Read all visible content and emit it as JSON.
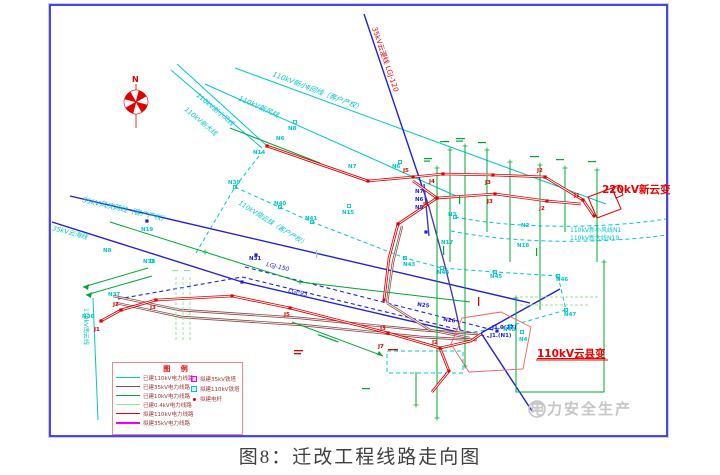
{
  "figure": {
    "caption": "图8：迁改工程线路走向图"
  },
  "watermark": {
    "text": "电力安全生产"
  },
  "legend": {
    "title": "图 例",
    "lines": [
      {
        "label": "已建110kV电力线路",
        "color": "#00c8c8",
        "weight": 1
      },
      {
        "label": "已建35kV电力线路",
        "color": "#8a4a4a",
        "weight": 1
      },
      {
        "label": "已建10kV电力线路",
        "color": "#00a832",
        "weight": 1
      },
      {
        "label": "已建0.4kV电力线路",
        "color": "#90e890",
        "weight": 1
      },
      {
        "label": "拟建110kV电力线路",
        "color": "#e80000",
        "weight": 1
      },
      {
        "label": "拟建35kV电力线路",
        "color": "#f000f0",
        "weight": 2
      }
    ],
    "symbols": [
      {
        "label": "拟建35kV铁塔",
        "type": "square",
        "color": "#f000f0"
      },
      {
        "label": "拟建110kV铁塔",
        "type": "square",
        "color": "#00c8c8"
      },
      {
        "label": "拟建电杆",
        "type": "dot",
        "color": "#e80000"
      }
    ]
  },
  "labels": [
    {
      "text": "N",
      "x": 132,
      "y": 82,
      "color": "#e00000",
      "size": 8,
      "bold": 1
    },
    {
      "text": "35kV云漫线  LGJ-120",
      "x": 372,
      "y": 28,
      "color": "#e80000",
      "size": 7,
      "rotate": 71
    },
    {
      "text": "110kV新小Ⅱ回线（客户产权）",
      "x": 272,
      "y": 76,
      "color": "#00c8c8",
      "size": 7,
      "rotate": 21,
      "italic": 1
    },
    {
      "text": "110kV新风线",
      "x": 238,
      "y": 100,
      "color": "#00c8c8",
      "size": 7,
      "rotate": 24,
      "italic": 1
    },
    {
      "text": "110kV新小风线",
      "x": 196,
      "y": 96,
      "color": "#00c8c8",
      "size": 6.5,
      "rotate": 40,
      "italic": 1
    },
    {
      "text": "110kV新大线",
      "x": 184,
      "y": 110,
      "color": "#00c8c8",
      "size": 6.5,
      "rotate": 40,
      "italic": 1
    },
    {
      "text": "35kV风庆网线（客户产权）",
      "x": 82,
      "y": 202,
      "color": "#00c8c8",
      "size": 7,
      "rotate": 13,
      "italic": 1
    },
    {
      "text": "35kV云海线",
      "x": 52,
      "y": 230,
      "color": "#00c8c8",
      "size": 6.5,
      "rotate": 15,
      "italic": 1
    },
    {
      "text": "110kV南云线（客户产权）",
      "x": 238,
      "y": 204,
      "color": "#00c8c8",
      "size": 6.5,
      "rotate": 32,
      "italic": 1
    },
    {
      "text": "110kV南云线",
      "x": 84,
      "y": 308,
      "color": "#00c8c8",
      "size": 6,
      "rotate": 90
    },
    {
      "text": "LGJ-150",
      "x": 266,
      "y": 266,
      "color": "#2020dd",
      "size": 6,
      "rotate": 13,
      "italic": 1
    },
    {
      "text": "LGJ-95",
      "x": 288,
      "y": 292,
      "color": "#2020dd",
      "size": 6,
      "rotate": 13,
      "italic": 1
    },
    {
      "text": "220kV新云变",
      "x": 602,
      "y": 193,
      "color": "#e80000",
      "size": 10.5,
      "bold": 1
    },
    {
      "text": "110kV云县变",
      "x": 537,
      "y": 357,
      "color": "#e80000",
      "size": 10.5,
      "bold": 1,
      "underline": 1
    },
    {
      "text": "110kV新小风线N1",
      "x": 570,
      "y": 232,
      "color": "#00c8c8",
      "size": 6
    },
    {
      "text": "110kV新大线N19",
      "x": 570,
      "y": 240,
      "color": "#00c8c8",
      "size": 6
    },
    {
      "text": "J1.0(27)",
      "x": 492,
      "y": 329,
      "color": "#2020dd",
      "size": 5.5,
      "bold": 1
    },
    {
      "text": "J1.(N1)",
      "x": 490,
      "y": 337,
      "color": "#2020dd",
      "size": 5.5,
      "bold": 1
    },
    {
      "text": "N14",
      "x": 253,
      "y": 154,
      "color": "#00c8c8",
      "size": 5.5,
      "bold": 1
    },
    {
      "text": "N6",
      "x": 276,
      "y": 140,
      "color": "#00c8c8",
      "size": 5.5,
      "bold": 1
    },
    {
      "text": "N8",
      "x": 288,
      "y": 130,
      "color": "#00c8c8",
      "size": 5.5,
      "bold": 1
    },
    {
      "text": "N7",
      "x": 348,
      "y": 168,
      "color": "#00c8c8",
      "size": 5.5,
      "bold": 1
    },
    {
      "text": "N6",
      "x": 392,
      "y": 168,
      "color": "#00c8c8",
      "size": 5.5,
      "bold": 1
    },
    {
      "text": "N15",
      "x": 342,
      "y": 214,
      "color": "#00c8c8",
      "size": 5.5,
      "bold": 1
    },
    {
      "text": "N39",
      "x": 228,
      "y": 184,
      "color": "#00c8c8",
      "size": 5.5,
      "bold": 1
    },
    {
      "text": "N40",
      "x": 274,
      "y": 205,
      "color": "#00c8c8",
      "size": 5.5,
      "bold": 1
    },
    {
      "text": "N41",
      "x": 305,
      "y": 220,
      "color": "#00c8c8",
      "size": 5.5,
      "bold": 1
    },
    {
      "text": "N19",
      "x": 141,
      "y": 231,
      "color": "#00c8c8",
      "size": 5.5,
      "bold": 1
    },
    {
      "text": "N8",
      "x": 103,
      "y": 252,
      "color": "#00c8c8",
      "size": 5.5,
      "bold": 1
    },
    {
      "text": "N38",
      "x": 143,
      "y": 263,
      "color": "#00c8c8",
      "size": 5.5,
      "bold": 1
    },
    {
      "text": "N36",
      "x": 82,
      "y": 318,
      "color": "#00c8c8",
      "size": 5.5,
      "bold": 1
    },
    {
      "text": "N37",
      "x": 108,
      "y": 296,
      "color": "#00c8c8",
      "size": 5.5,
      "bold": 1
    },
    {
      "text": "N43",
      "x": 403,
      "y": 266,
      "color": "#00c8c8",
      "size": 5.5,
      "bold": 1
    },
    {
      "text": "N44",
      "x": 437,
      "y": 274,
      "color": "#00c8c8",
      "size": 5.5,
      "bold": 1
    },
    {
      "text": "N45",
      "x": 490,
      "y": 278,
      "color": "#00c8c8",
      "size": 5.5,
      "bold": 1
    },
    {
      "text": "N46",
      "x": 556,
      "y": 281,
      "color": "#00c8c8",
      "size": 5.5,
      "bold": 1
    },
    {
      "text": "N47",
      "x": 564,
      "y": 316,
      "color": "#00c8c8",
      "size": 5.5,
      "bold": 1
    },
    {
      "text": "N48",
      "x": 503,
      "y": 331,
      "color": "#00c8c8",
      "size": 5.5,
      "bold": 1
    },
    {
      "text": "N2",
      "x": 521,
      "y": 227,
      "color": "#00c8c8",
      "size": 5.5,
      "bold": 1
    },
    {
      "text": "N3",
      "x": 448,
      "y": 216,
      "color": "#00c8c8",
      "size": 5.5,
      "bold": 1
    },
    {
      "text": "N17",
      "x": 441,
      "y": 244,
      "color": "#00c8c8",
      "size": 5.5,
      "bold": 1
    },
    {
      "text": "N18",
      "x": 517,
      "y": 247,
      "color": "#00c8c8",
      "size": 5.5,
      "bold": 1
    },
    {
      "text": "N4",
      "x": 519,
      "y": 341,
      "color": "#00c8c8",
      "size": 5.5,
      "bold": 1
    },
    {
      "text": "N7",
      "x": 415,
      "y": 193,
      "color": "#2020dd",
      "size": 5.5,
      "bold": 1
    },
    {
      "text": "N6",
      "x": 415,
      "y": 201,
      "color": "#2020dd",
      "size": 5.5,
      "bold": 1
    },
    {
      "text": "N5",
      "x": 415,
      "y": 209,
      "color": "#2020dd",
      "size": 5.5,
      "bold": 1
    },
    {
      "text": "N31",
      "x": 249,
      "y": 260,
      "color": "#2020dd",
      "size": 5.5,
      "bold": 1
    },
    {
      "text": "N25",
      "x": 417,
      "y": 306,
      "color": "#2020dd",
      "size": 5.5,
      "bold": 1,
      "rotate": 8
    },
    {
      "text": "N26",
      "x": 443,
      "y": 321,
      "color": "#2020dd",
      "size": 5.5,
      "bold": 1,
      "rotate": 8
    },
    {
      "text": "J5",
      "x": 403,
      "y": 172,
      "color": "#e00000",
      "size": 5.5,
      "bold": 1
    },
    {
      "text": "J4",
      "x": 429,
      "y": 183,
      "color": "#e00000",
      "size": 5.5,
      "bold": 1
    },
    {
      "text": "J3",
      "x": 485,
      "y": 184,
      "color": "#e00000",
      "size": 5.5,
      "bold": 1
    },
    {
      "text": "J2",
      "x": 537,
      "y": 172,
      "color": "#e00000",
      "size": 5.5,
      "bold": 1
    },
    {
      "text": "J1",
      "x": 574,
      "y": 197,
      "color": "#e00000",
      "size": 5.5,
      "bold": 1
    },
    {
      "text": "J4",
      "x": 423,
      "y": 206,
      "color": "#e00000",
      "size": 5.5,
      "bold": 1
    },
    {
      "text": "J3",
      "x": 487,
      "y": 203,
      "color": "#e00000",
      "size": 5.5,
      "bold": 1
    },
    {
      "text": "J2",
      "x": 539,
      "y": 210,
      "color": "#e00000",
      "size": 5.5,
      "bold": 1
    },
    {
      "text": "J1",
      "x": 94,
      "y": 331,
      "color": "#e00000",
      "size": 5.5,
      "bold": 1
    },
    {
      "text": "J2",
      "x": 113,
      "y": 306,
      "color": "#e00000",
      "size": 5.5,
      "bold": 1
    },
    {
      "text": "J3",
      "x": 150,
      "y": 309,
      "color": "#e00000",
      "size": 5.5,
      "bold": 1
    },
    {
      "text": "J5",
      "x": 284,
      "y": 316,
      "color": "#e00000",
      "size": 5.5,
      "bold": 1
    },
    {
      "text": "J3",
      "x": 380,
      "y": 330,
      "color": "#e00000",
      "size": 5.5,
      "bold": 1
    },
    {
      "text": "J7",
      "x": 378,
      "y": 348,
      "color": "#e00000",
      "size": 5.5,
      "bold": 1
    },
    {
      "text": "J2",
      "x": 432,
      "y": 344,
      "color": "#e00000",
      "size": 5.5,
      "bold": 1
    }
  ],
  "towers": [
    {
      "x": 368,
      "y": 181,
      "type": "sq-red"
    },
    {
      "x": 413,
      "y": 177,
      "type": "sq-red"
    },
    {
      "x": 443,
      "y": 174,
      "type": "sq-red"
    },
    {
      "x": 493,
      "y": 175,
      "type": "sq-red"
    },
    {
      "x": 545,
      "y": 177,
      "type": "sq-red"
    },
    {
      "x": 583,
      "y": 200,
      "type": "sq-red"
    },
    {
      "x": 437,
      "y": 198,
      "type": "sq-red"
    },
    {
      "x": 495,
      "y": 194,
      "type": "sq-red"
    },
    {
      "x": 547,
      "y": 201,
      "type": "sq-red"
    },
    {
      "x": 398,
      "y": 224,
      "type": "sq-red"
    },
    {
      "x": 267,
      "y": 146,
      "type": "sq-red"
    },
    {
      "x": 101,
      "y": 321,
      "type": "sq-red"
    },
    {
      "x": 121,
      "y": 310,
      "type": "sq-red"
    },
    {
      "x": 156,
      "y": 300,
      "type": "sq-red"
    },
    {
      "x": 232,
      "y": 296,
      "type": "sq-red"
    },
    {
      "x": 290,
      "y": 308,
      "type": "sq-red"
    },
    {
      "x": 388,
      "y": 333,
      "type": "sq-red"
    },
    {
      "x": 440,
      "y": 348,
      "type": "sq-red"
    },
    {
      "x": 384,
      "y": 300,
      "type": "dot-red"
    },
    {
      "x": 449,
      "y": 371,
      "type": "dot-red"
    },
    {
      "x": 594,
      "y": 216,
      "type": "dot-red"
    },
    {
      "x": 235,
      "y": 187,
      "type": "sq-cyan"
    },
    {
      "x": 280,
      "y": 207,
      "type": "sq-cyan"
    },
    {
      "x": 312,
      "y": 222,
      "type": "sq-cyan"
    },
    {
      "x": 405,
      "y": 258,
      "type": "sq-cyan"
    },
    {
      "x": 442,
      "y": 268,
      "type": "sq-cyan"
    },
    {
      "x": 495,
      "y": 272,
      "type": "sq-cyan"
    },
    {
      "x": 558,
      "y": 276,
      "type": "sq-cyan"
    },
    {
      "x": 566,
      "y": 310,
      "type": "sq-cyan"
    },
    {
      "x": 510,
      "y": 326,
      "type": "sq-cyan"
    },
    {
      "x": 295,
      "y": 122,
      "type": "sq-cyan"
    },
    {
      "x": 400,
      "y": 162,
      "type": "sq-cyan"
    },
    {
      "x": 349,
      "y": 206,
      "type": "sq-cyan"
    },
    {
      "x": 455,
      "y": 217,
      "type": "sq-cyan"
    },
    {
      "x": 522,
      "y": 332,
      "type": "sq-cyan"
    },
    {
      "x": 152,
      "y": 261,
      "type": "sq-cyan"
    },
    {
      "x": 147,
      "y": 221,
      "type": "sq-blue"
    },
    {
      "x": 256,
      "y": 255,
      "type": "sq-blue"
    },
    {
      "x": 242,
      "y": 282,
      "type": "sq-blue"
    },
    {
      "x": 497,
      "y": 331,
      "type": "sq-blue"
    },
    {
      "x": 426,
      "y": 232,
      "type": "sq-blue"
    },
    {
      "x": 437,
      "y": 168,
      "type": "tick-green"
    },
    {
      "x": 450,
      "y": 150,
      "type": "tick-green"
    },
    {
      "x": 465,
      "y": 146,
      "type": "tick-green"
    },
    {
      "x": 487,
      "y": 150,
      "type": "tick-green"
    },
    {
      "x": 510,
      "y": 162,
      "type": "tick-green"
    },
    {
      "x": 540,
      "y": 165,
      "type": "tick-green"
    },
    {
      "x": 565,
      "y": 168,
      "type": "tick-green"
    },
    {
      "x": 597,
      "y": 170,
      "type": "tick-green"
    },
    {
      "x": 437,
      "y": 418,
      "type": "tick-green"
    },
    {
      "x": 416,
      "y": 405,
      "type": "tick-green"
    },
    {
      "x": 465,
      "y": 366,
      "type": "tick-green"
    },
    {
      "x": 300,
      "y": 282,
      "type": "tick-green"
    },
    {
      "x": 205,
      "y": 252,
      "type": "tick-green"
    },
    {
      "x": 516,
      "y": 298,
      "type": "tick-green"
    },
    {
      "x": 604,
      "y": 262,
      "type": "tick-green"
    }
  ]
}
